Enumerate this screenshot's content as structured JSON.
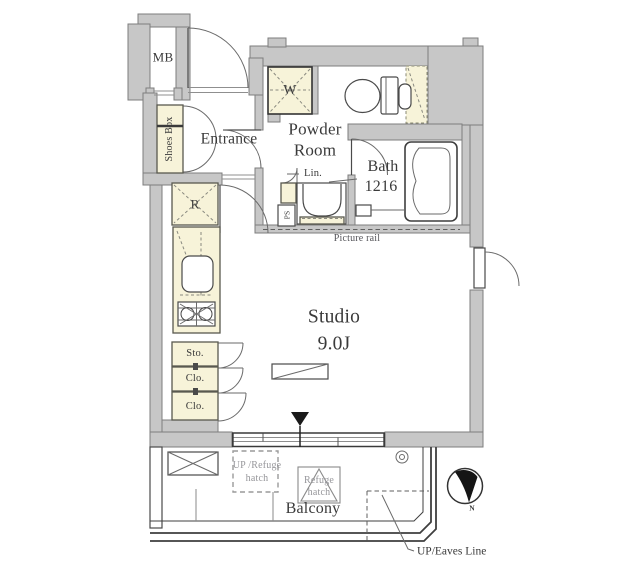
{
  "plan": {
    "rooms": {
      "entrance": "Entrance",
      "powder_room_line1": "Powder",
      "powder_room_line2": "Room",
      "bath_line1": "Bath",
      "bath_line2": "1216",
      "studio_line1": "Studio",
      "studio_line2": "9.0J",
      "balcony": "Balcony"
    },
    "fixtures": {
      "meter_box": "MB",
      "shoes_box": "Shoes Box",
      "washer": "W",
      "linen": "Lin.",
      "pipe_space": "PS",
      "refrigerator": "R",
      "storage": "Sto.",
      "closet1": "Clo.",
      "closet2": "Clo."
    },
    "annotations": {
      "picture_rail": "Picture rail",
      "up_refuge_line1": "UP /Refuge",
      "up_refuge_line2": "hatch",
      "refuge_line1": "Refuge",
      "refuge_line2": "hatch",
      "up_eaves": "UP/Eaves Line",
      "north": "N"
    },
    "colors": {
      "wall": "#c7c7c7",
      "wall_edge": "#7d7d7d",
      "fixture": "#f7f3d9",
      "line": "#4a4a4a",
      "text": "#3a3a3a",
      "muted_text": "#96969a"
    }
  }
}
